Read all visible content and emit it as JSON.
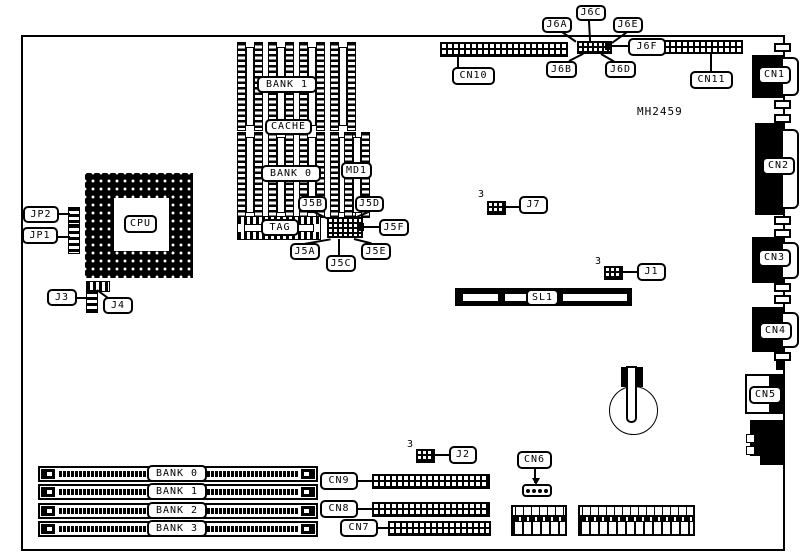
{
  "board": {
    "part_number": "MH2459"
  },
  "colors": {
    "ink": "#000000",
    "paper": "#ffffff"
  },
  "labels": {
    "jp2": "JP2",
    "jp1": "JP1",
    "cpu": "CPU",
    "j3": "J3",
    "j4": "J4",
    "cache_bank1": "BANK 1",
    "cache": "CACHE",
    "cache_bank0": "BANK 0",
    "md1": "MD1",
    "tag": "TAG",
    "j5a": "J5A",
    "j5b": "J5B",
    "j5c": "J5C",
    "j5d": "J5D",
    "j5e": "J5E",
    "j5f": "J5F",
    "j6a": "J6A",
    "j6b": "J6B",
    "j6c": "J6C",
    "j6d": "J6D",
    "j6e": "J6E",
    "j6f": "J6F",
    "cn10": "CN10",
    "cn11": "CN11",
    "cn1": "CN1",
    "cn2": "CN2",
    "cn3": "CN3",
    "cn4": "CN4",
    "cn5": "CN5",
    "j7": "J7",
    "j1": "J1",
    "j2": "J2",
    "sl1": "SL1",
    "simm_bank0": "BANK 0",
    "simm_bank1": "BANK 1",
    "simm_bank2": "BANK 2",
    "simm_bank3": "BANK 3",
    "cn9": "CN9",
    "cn8": "CN8",
    "cn7": "CN7",
    "cn6": "CN6",
    "pin1_marker": "3"
  }
}
